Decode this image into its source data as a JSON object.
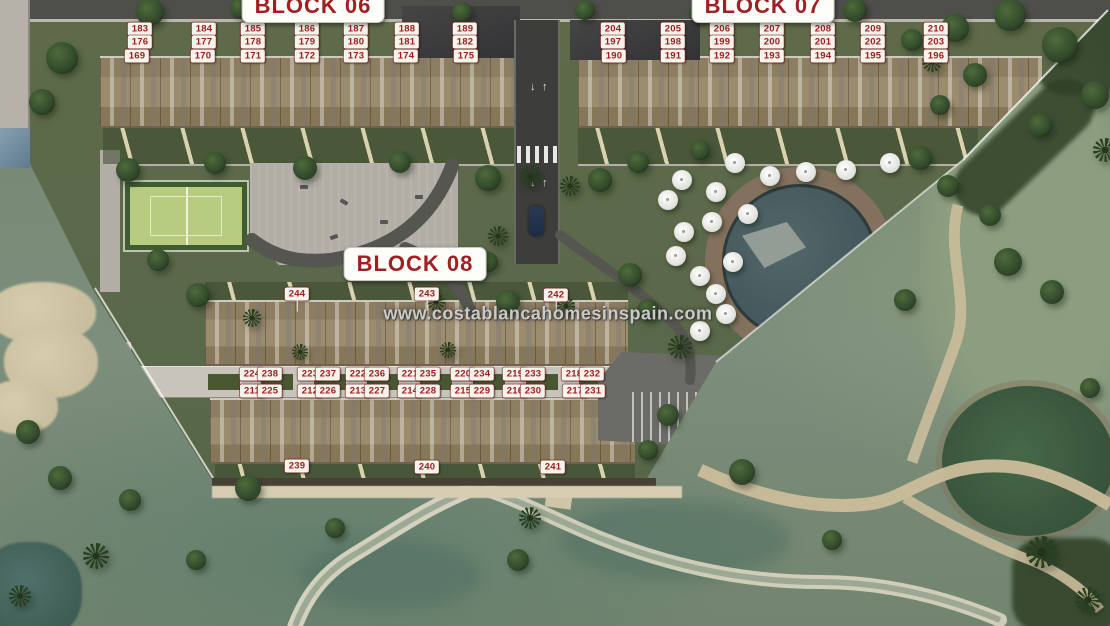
{
  "site": {
    "watermark": "www.costablancahomesinspain.com",
    "blocks": [
      {
        "id": "block-06",
        "title": "BLOCK 06",
        "x": 313,
        "y": 6
      },
      {
        "id": "block-07",
        "title": "BLOCK 07",
        "x": 763,
        "y": 6
      },
      {
        "id": "block-08",
        "title": "BLOCK 08",
        "x": 415,
        "y": 264
      }
    ],
    "road_markings": {
      "up_arrow": "↑",
      "down_arrow": "↓"
    },
    "unit_labels": [
      {
        "n": "183",
        "x": 140,
        "y": 29
      },
      {
        "n": "184",
        "x": 204,
        "y": 29
      },
      {
        "n": "185",
        "x": 253,
        "y": 29
      },
      {
        "n": "186",
        "x": 307,
        "y": 29
      },
      {
        "n": "187",
        "x": 356,
        "y": 29
      },
      {
        "n": "188",
        "x": 407,
        "y": 29
      },
      {
        "n": "189",
        "x": 465,
        "y": 29
      },
      {
        "n": "176",
        "x": 140,
        "y": 42
      },
      {
        "n": "177",
        "x": 204,
        "y": 42
      },
      {
        "n": "178",
        "x": 253,
        "y": 42
      },
      {
        "n": "179",
        "x": 307,
        "y": 42
      },
      {
        "n": "180",
        "x": 356,
        "y": 42
      },
      {
        "n": "181",
        "x": 407,
        "y": 42
      },
      {
        "n": "182",
        "x": 465,
        "y": 42
      },
      {
        "n": "169",
        "x": 137,
        "y": 56
      },
      {
        "n": "170",
        "x": 203,
        "y": 56
      },
      {
        "n": "171",
        "x": 253,
        "y": 56
      },
      {
        "n": "172",
        "x": 307,
        "y": 56
      },
      {
        "n": "173",
        "x": 356,
        "y": 56
      },
      {
        "n": "174",
        "x": 406,
        "y": 56
      },
      {
        "n": "175",
        "x": 466,
        "y": 56
      },
      {
        "n": "204",
        "x": 613,
        "y": 29
      },
      {
        "n": "205",
        "x": 673,
        "y": 29
      },
      {
        "n": "206",
        "x": 722,
        "y": 29
      },
      {
        "n": "207",
        "x": 772,
        "y": 29
      },
      {
        "n": "208",
        "x": 823,
        "y": 29
      },
      {
        "n": "209",
        "x": 873,
        "y": 29
      },
      {
        "n": "210",
        "x": 936,
        "y": 29
      },
      {
        "n": "197",
        "x": 613,
        "y": 42
      },
      {
        "n": "198",
        "x": 673,
        "y": 42
      },
      {
        "n": "199",
        "x": 722,
        "y": 42
      },
      {
        "n": "200",
        "x": 772,
        "y": 42
      },
      {
        "n": "201",
        "x": 823,
        "y": 42
      },
      {
        "n": "202",
        "x": 873,
        "y": 42
      },
      {
        "n": "203",
        "x": 936,
        "y": 42
      },
      {
        "n": "190",
        "x": 614,
        "y": 56
      },
      {
        "n": "191",
        "x": 673,
        "y": 56
      },
      {
        "n": "192",
        "x": 722,
        "y": 56
      },
      {
        "n": "193",
        "x": 772,
        "y": 56
      },
      {
        "n": "194",
        "x": 823,
        "y": 56
      },
      {
        "n": "195",
        "x": 873,
        "y": 56
      },
      {
        "n": "196",
        "x": 936,
        "y": 56
      },
      {
        "n": "244",
        "x": 297,
        "y": 294,
        "leader": "down"
      },
      {
        "n": "243",
        "x": 427,
        "y": 294,
        "leader": "down"
      },
      {
        "n": "242",
        "x": 556,
        "y": 295,
        "leader": "down"
      },
      {
        "n": "224",
        "x": 252,
        "y": 374
      },
      {
        "n": "238",
        "x": 270,
        "y": 374
      },
      {
        "n": "223",
        "x": 310,
        "y": 374
      },
      {
        "n": "237",
        "x": 328,
        "y": 374
      },
      {
        "n": "222",
        "x": 358,
        "y": 374
      },
      {
        "n": "236",
        "x": 377,
        "y": 374
      },
      {
        "n": "221",
        "x": 410,
        "y": 374
      },
      {
        "n": "235",
        "x": 428,
        "y": 374
      },
      {
        "n": "220",
        "x": 463,
        "y": 374
      },
      {
        "n": "234",
        "x": 482,
        "y": 374
      },
      {
        "n": "219",
        "x": 515,
        "y": 374
      },
      {
        "n": "233",
        "x": 533,
        "y": 374
      },
      {
        "n": "218",
        "x": 574,
        "y": 374
      },
      {
        "n": "232",
        "x": 592,
        "y": 374
      },
      {
        "n": "211",
        "x": 252,
        "y": 391
      },
      {
        "n": "225",
        "x": 270,
        "y": 391
      },
      {
        "n": "212",
        "x": 310,
        "y": 391
      },
      {
        "n": "226",
        "x": 328,
        "y": 391
      },
      {
        "n": "213",
        "x": 358,
        "y": 391
      },
      {
        "n": "227",
        "x": 377,
        "y": 391
      },
      {
        "n": "214",
        "x": 410,
        "y": 391
      },
      {
        "n": "228",
        "x": 428,
        "y": 391
      },
      {
        "n": "215",
        "x": 463,
        "y": 391
      },
      {
        "n": "229",
        "x": 482,
        "y": 391
      },
      {
        "n": "216",
        "x": 515,
        "y": 391
      },
      {
        "n": "230",
        "x": 533,
        "y": 391
      },
      {
        "n": "217",
        "x": 575,
        "y": 391
      },
      {
        "n": "231",
        "x": 593,
        "y": 391
      },
      {
        "n": "239",
        "x": 297,
        "y": 466
      },
      {
        "n": "240",
        "x": 427,
        "y": 467
      },
      {
        "n": "241",
        "x": 553,
        "y": 467
      }
    ],
    "colors": {
      "label_red": "#9e1b1e",
      "label_bg": "#f7f3ea",
      "road": "#3d3d3b",
      "parcel_grass": "#5c684a",
      "golf_grass": "#7c8d7b",
      "building_tan": "#93836a",
      "pool_water": "#44585a",
      "bunker_sand": "#cfc6a8",
      "plaza_gray": "#b2aea6",
      "court_green": "#b7cc80"
    },
    "scenery": {
      "umbrellas": [
        [
          735,
          163
        ],
        [
          770,
          176
        ],
        [
          806,
          172
        ],
        [
          846,
          170
        ],
        [
          890,
          163
        ],
        [
          682,
          180
        ],
        [
          716,
          192
        ],
        [
          748,
          214
        ],
        [
          668,
          200
        ],
        [
          684,
          232
        ],
        [
          712,
          222
        ],
        [
          676,
          256
        ],
        [
          700,
          276
        ],
        [
          733,
          262
        ],
        [
          716,
          294
        ],
        [
          726,
          314
        ],
        [
          700,
          331
        ]
      ],
      "trees": [
        [
          62,
          58,
          16
        ],
        [
          42,
          102,
          13
        ],
        [
          150,
          12,
          14
        ],
        [
          240,
          8,
          10
        ],
        [
          350,
          6,
          12
        ],
        [
          128,
          170,
          12
        ],
        [
          215,
          163,
          11
        ],
        [
          305,
          168,
          12
        ],
        [
          400,
          162,
          11
        ],
        [
          488,
          178,
          13
        ],
        [
          462,
          12,
          10
        ],
        [
          585,
          10,
          10
        ],
        [
          700,
          12,
          11
        ],
        [
          855,
          10,
          12
        ],
        [
          912,
          40,
          11
        ],
        [
          955,
          28,
          14
        ],
        [
          1010,
          15,
          16
        ],
        [
          1060,
          45,
          18
        ],
        [
          1095,
          95,
          14
        ],
        [
          1040,
          125,
          12
        ],
        [
          975,
          75,
          12
        ],
        [
          940,
          105,
          10
        ],
        [
          600,
          180,
          12
        ],
        [
          638,
          162,
          11
        ],
        [
          920,
          158,
          12
        ],
        [
          948,
          186,
          11
        ],
        [
          630,
          275,
          12
        ],
        [
          648,
          310,
          11
        ],
        [
          700,
          150,
          10
        ],
        [
          508,
          302,
          12
        ],
        [
          488,
          262,
          10
        ],
        [
          198,
          295,
          12
        ],
        [
          158,
          260,
          11
        ],
        [
          668,
          415,
          11
        ],
        [
          648,
          450,
          10
        ],
        [
          248,
          488,
          13
        ],
        [
          130,
          500,
          11
        ],
        [
          60,
          478,
          12
        ],
        [
          335,
          528,
          10
        ],
        [
          28,
          432,
          12
        ],
        [
          742,
          472,
          13
        ],
        [
          832,
          540,
          10
        ],
        [
          518,
          560,
          11
        ],
        [
          196,
          560,
          10
        ],
        [
          905,
          300,
          11
        ],
        [
          1008,
          262,
          14
        ],
        [
          1052,
          292,
          12
        ],
        [
          990,
          215,
          11
        ],
        [
          1090,
          388,
          10
        ]
      ],
      "palms": [
        [
          680,
          347,
          12
        ],
        [
          530,
          176,
          11
        ],
        [
          570,
          186,
          10
        ],
        [
          498,
          236,
          10
        ],
        [
          1042,
          552,
          16
        ],
        [
          1088,
          600,
          13
        ],
        [
          96,
          556,
          13
        ],
        [
          20,
          596,
          11
        ],
        [
          436,
          302,
          9
        ],
        [
          252,
          318,
          9
        ],
        [
          566,
          306,
          9
        ],
        [
          530,
          518,
          11
        ],
        [
          448,
          350,
          8
        ],
        [
          300,
          352,
          8
        ],
        [
          1105,
          150,
          12
        ],
        [
          932,
          62,
          10
        ]
      ]
    }
  }
}
